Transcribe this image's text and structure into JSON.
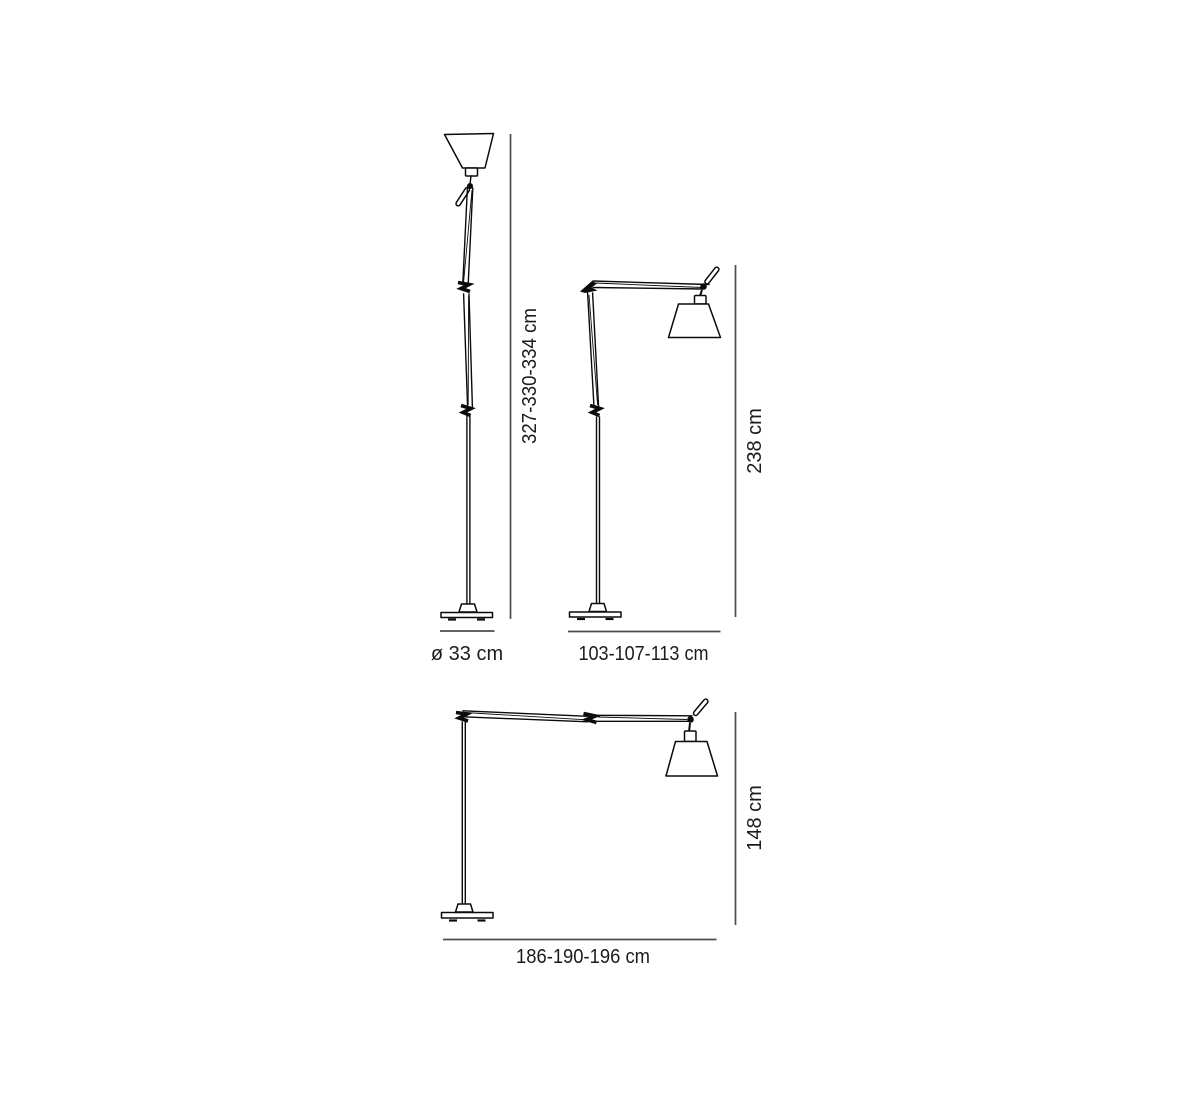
{
  "diagram": {
    "type": "product-dimension-drawing",
    "views": [
      {
        "name": "floor-lamp-upright",
        "height_label": "327-330-334 cm",
        "width_label": "ø 33 cm"
      },
      {
        "name": "floor-lamp-mid-extension",
        "height_label": "238 cm",
        "width_label": "103-107-113 cm"
      },
      {
        "name": "floor-lamp-full-extension",
        "height_label": "148 cm",
        "width_label": "186-190-196 cm"
      }
    ],
    "colors": {
      "line": "#0b0b0b",
      "dimension": "#4d4d4d",
      "text": "#1c1c1c",
      "background": "#ffffff"
    }
  }
}
